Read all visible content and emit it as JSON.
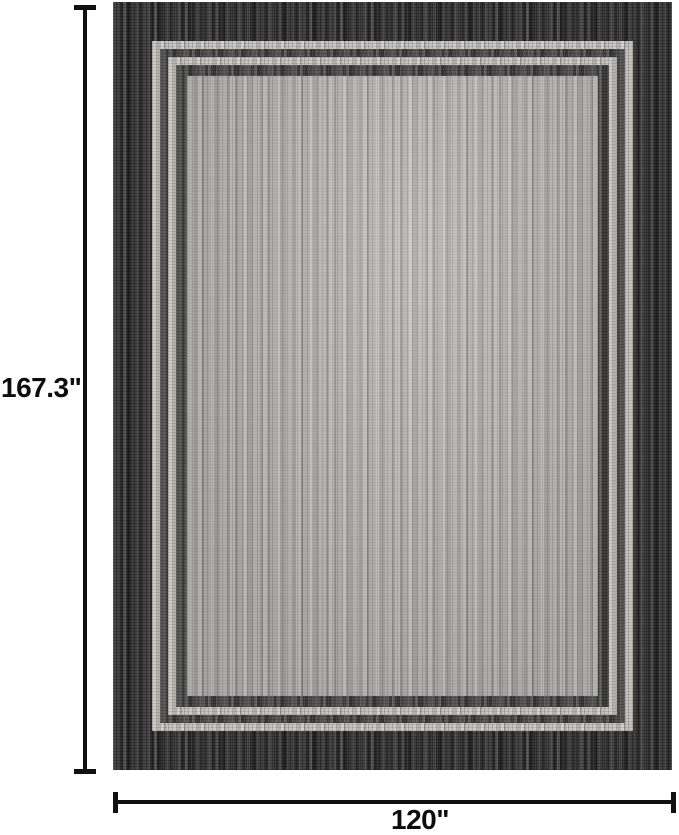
{
  "diagram": {
    "type": "product-dimension-diagram",
    "subject": "bordered flatweave area rug, top view",
    "height": {
      "label": "167.3\"",
      "value": 167.3,
      "unit": "inches"
    },
    "width": {
      "label": "120\"",
      "value": 120,
      "unit": "inches"
    }
  },
  "colors": {
    "background": "#ffffff",
    "rug_outer_border": "#383838",
    "rug_accent_stripe_light": "#c4c2bd",
    "rug_accent_stripe_dark": "#4a4a4a",
    "rug_field": "#b1afab",
    "dimension_lines": "#111111",
    "label_text": "#0d0d0d"
  }
}
